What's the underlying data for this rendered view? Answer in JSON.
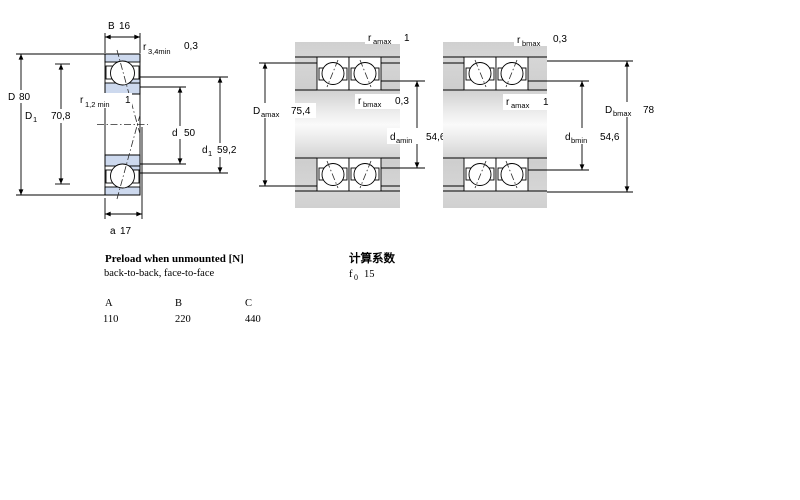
{
  "figure_bearing_section": {
    "dims": {
      "B": {
        "base": "B",
        "value": "16"
      },
      "r34": {
        "base": "r",
        "sub": "3,4min",
        "value": "0,3"
      },
      "D": {
        "base": "D",
        "value": "80"
      },
      "D1": {
        "base": "D",
        "sub": "1",
        "value": "70,8"
      },
      "r12": {
        "base": "r",
        "sub": "1,2 min",
        "value": "1"
      },
      "d": {
        "base": "d",
        "value": "50"
      },
      "d1": {
        "base": "d",
        "sub": "1",
        "value": "59,2"
      },
      "a": {
        "base": "a",
        "value": "17"
      }
    }
  },
  "figure_back_to_back": {
    "dims": {
      "ramax": {
        "base": "r",
        "sub": "amax",
        "value": "1"
      },
      "rbmax": {
        "base": "r",
        "sub": "bmax",
        "value": "0,3"
      },
      "Damax": {
        "base": "D",
        "sub": "amax",
        "value": "75,4"
      },
      "damin": {
        "base": "d",
        "sub": "amin",
        "value": "54,6"
      }
    }
  },
  "figure_face_to_face": {
    "dims": {
      "rbmax": {
        "base": "r",
        "sub": "bmax",
        "value": "0,3"
      },
      "ramax": {
        "base": "r",
        "sub": "amax",
        "value": "1"
      },
      "Dbmax": {
        "base": "D",
        "sub": "bmax",
        "value": "78"
      },
      "dbmin": {
        "base": "d",
        "sub": "bmin",
        "value": "54,6"
      }
    }
  },
  "preload": {
    "title": "Preload when unmounted [N]",
    "subtitle": "back-to-back, face-to-face",
    "columns": [
      "A",
      "B",
      "C"
    ],
    "values": [
      "110",
      "220",
      "440"
    ]
  },
  "calculation": {
    "title": "计算系数",
    "f0": {
      "base": "f",
      "sub": "0",
      "value": "15"
    }
  },
  "colors": {
    "ring_fill": "#cdd9ee",
    "housing_gray": "#d2d2d2"
  }
}
